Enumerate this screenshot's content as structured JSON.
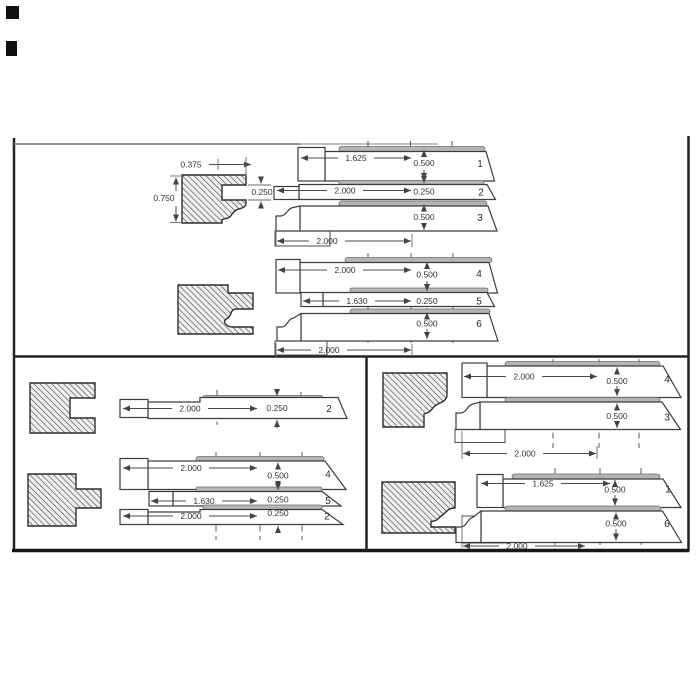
{
  "colors": {
    "paper": "#ffffff",
    "ink": "#2f2f2f",
    "hatch_line": "#404040",
    "highlight_strip": "#b5b5b5",
    "border": "#1f1f1f"
  },
  "sections": {
    "top": {
      "row_a": {
        "profile": {
          "width_top": "0.375",
          "height": "0.750",
          "notch_depth": "0.250"
        },
        "blades": [
          {
            "number": "1",
            "length": "1.625",
            "thickness": "0.500"
          },
          {
            "number": "2",
            "length": "2.000",
            "thickness": "0.250"
          },
          {
            "number": "3",
            "thickness": "0.500"
          }
        ],
        "overall_width": "2.000"
      },
      "row_b": {
        "blades": [
          {
            "number": "4",
            "length": "2.000",
            "thickness": "0.500"
          },
          {
            "number": "5",
            "length": "1.630",
            "thickness": "0.250"
          },
          {
            "number": "6",
            "thickness": "0.500"
          }
        ],
        "overall_width": "2.000"
      }
    },
    "bottom_left": {
      "row_a": {
        "blades": [
          {
            "number": "2",
            "length": "2.000",
            "thickness": "0.250"
          }
        ]
      },
      "row_b": {
        "blades": [
          {
            "number": "4",
            "length": "2.000",
            "thickness": "0.500"
          },
          {
            "number": "5",
            "length": "1.630",
            "thickness": "0.250"
          },
          {
            "number": "2",
            "length": "2.000",
            "thickness": "0.250"
          }
        ]
      }
    },
    "bottom_right": {
      "row_a": {
        "blades": [
          {
            "number": "4",
            "length": "2.000",
            "thickness": "0.500"
          },
          {
            "number": "3",
            "thickness": "0.500"
          }
        ],
        "overall_width": "2.000"
      },
      "row_b": {
        "blades": [
          {
            "number": "1",
            "length": "1.625",
            "thickness": "0.500"
          },
          {
            "number": "6",
            "thickness": "0.500"
          }
        ],
        "overall_width": "2.000"
      }
    }
  }
}
